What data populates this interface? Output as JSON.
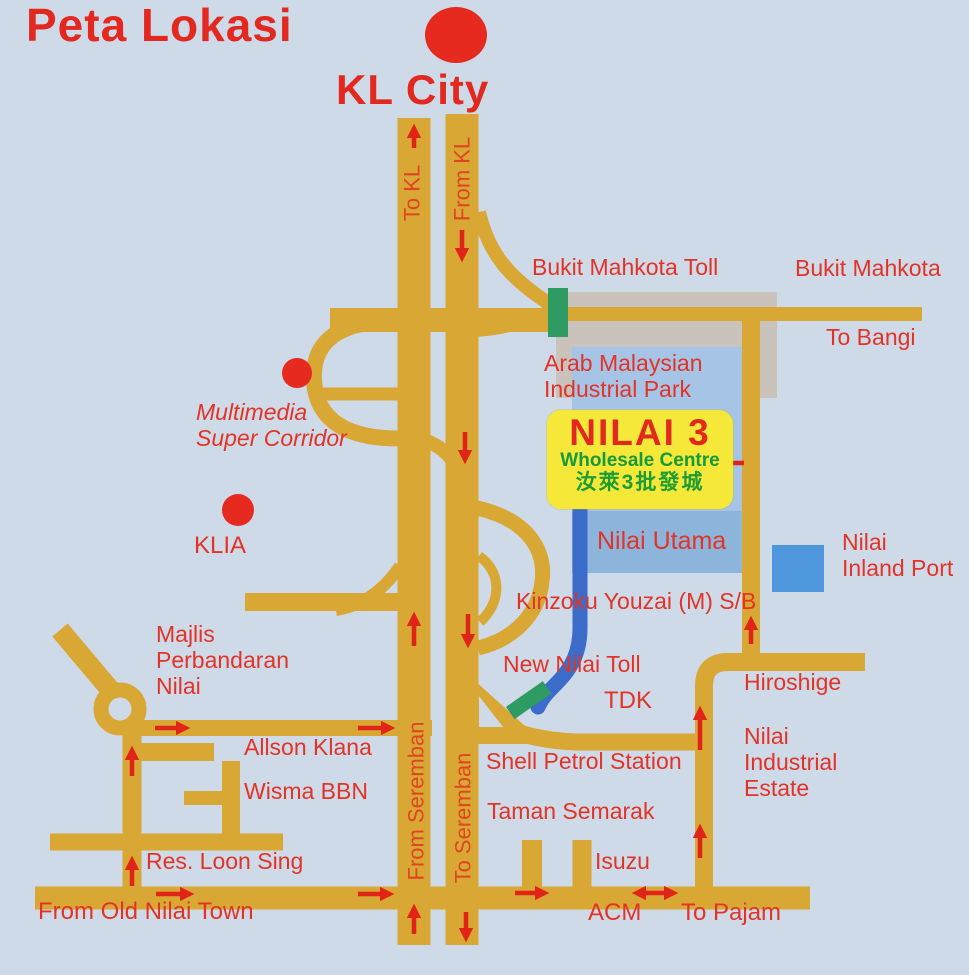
{
  "map_title": "Peta Lokasi",
  "colors": {
    "background": "#cfdae8",
    "road": "#d9a733",
    "label_red": "#e23326",
    "road_label_red": "#df4524",
    "toll_green": "#2d9b62",
    "blue_route": "#3b6cc9",
    "inland_port_blue": "#4e97dd",
    "park_light_blue": "#a6c4e6",
    "park_medium_blue": "#8db4da",
    "industrial_gray": "#cac3bb",
    "highlight_yellow": "#f5e838"
  },
  "icons": {
    "kl_city_dot": "red-dot",
    "msc_dot": "red-dot",
    "klia_dot": "red-dot",
    "bukit_mahkota_toll_marker": "green-toll-bar",
    "new_nilai_toll_marker": "green-toll-bar",
    "nilai_inland_port_marker": "blue-square",
    "roundabout": "road-ring",
    "route_arrow": "red-arrow"
  },
  "labels": {
    "peta_lokasi": "Peta Lokasi",
    "kl_city": "KL City",
    "to_kl": "To KL",
    "from_kl": "From KL",
    "bukit_mahkota_toll": "Bukit Mahkota Toll",
    "bukit_mahkota": "Bukit Mahkota",
    "to_bangi": "To Bangi",
    "arab_malaysian_industrial_park": "Arab Malaysian\nIndustrial Park",
    "multimedia_super_corridor": "Multimedia\nSuper Corridor",
    "klia": "KLIA",
    "nilai_utama": "Nilai Utama",
    "nilai_inland_port": "Nilai\nInland Port",
    "kinzoku_youzai": "Kinzoku Youzai (M) S/B",
    "majlis_perbandaran_nilai": "Majlis\nPerbandaran\nNilai",
    "new_nilai_toll": "New Nilai Toll",
    "tdk": "TDK",
    "hiroshige": "Hiroshige",
    "nilai_industrial_estate": "Nilai\nIndustrial\nEstate",
    "shell_petrol_station": "Shell Petrol Station",
    "allson_klana": "Allson Klana",
    "wisma_bbn": "Wisma BBN",
    "res_loon_sing": "Res. Loon Sing",
    "from_old_nilai_town": "From Old Nilai Town",
    "taman_semarak": "Taman Semarak",
    "isuzu": "Isuzu",
    "acm": "ACM",
    "to_pajam": "To Pajam",
    "from_seremban": "From Seremban",
    "to_seremban": "To Seremban",
    "nilai_3": "NILAI 3",
    "wholesale_centre": "Wholesale Centre",
    "nilai_3_chinese": "汝萊3批發城"
  }
}
